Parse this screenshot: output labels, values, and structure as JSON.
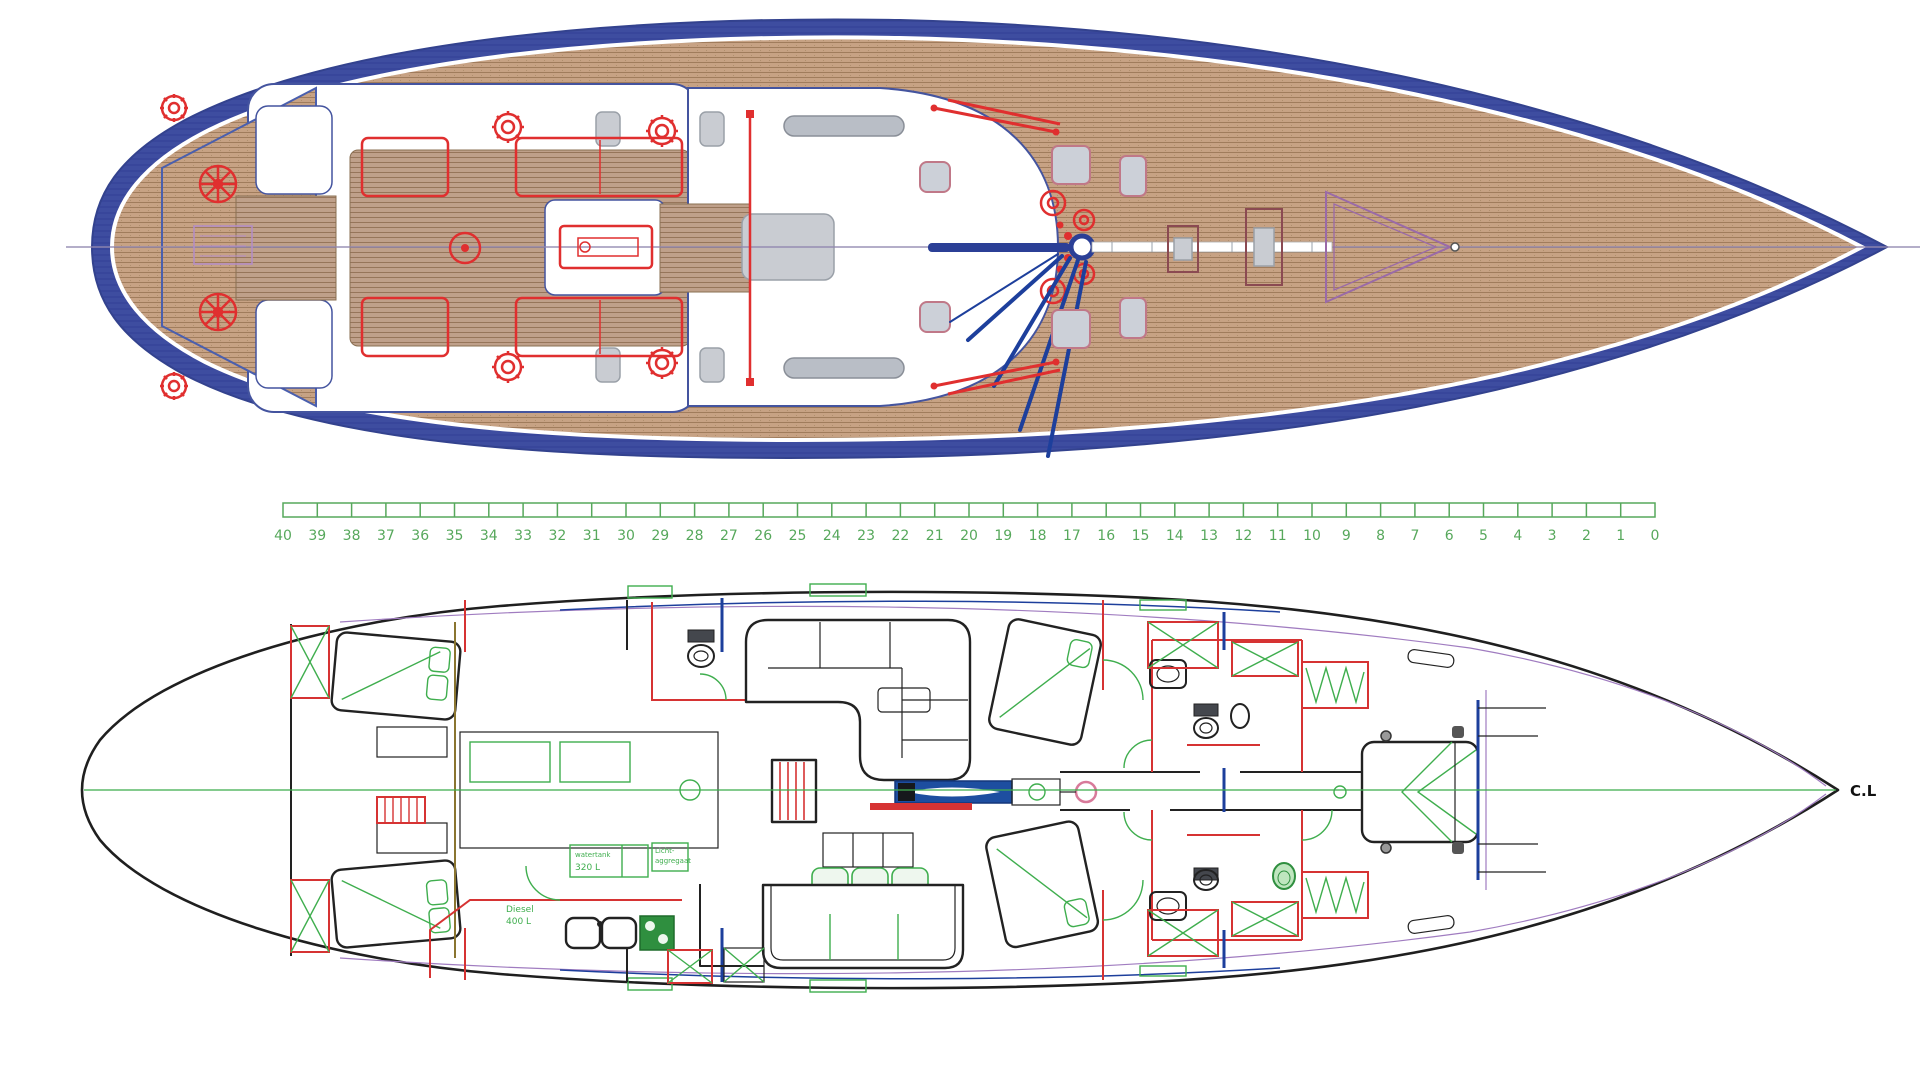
{
  "drawing": {
    "type": "yacht general arrangement drawing",
    "views": [
      "deck-plan",
      "frame-ruler",
      "interior-accommodation-plan"
    ]
  },
  "colors": {
    "deck-blue": "#3e4da0",
    "deck-blue-dark": "#33428e",
    "teak": "#c7a284",
    "teak-line": "#a07c5c",
    "cockpit-floor": "#bfa08a",
    "coach-edge": "#44549f",
    "hw-red": "#e02f2f",
    "gray-hatch": "#c9ccd2",
    "rail-gray": "#b9bec6",
    "pink": "#c07888",
    "maroon": "#8b4a52",
    "purple": "#a07cc0",
    "ruler-green": "#57a85c",
    "plan-black": "#222222",
    "plan-red": "#d63333",
    "plan-green": "#3fae4e",
    "plan-blue": "#1d3f9c",
    "trunk-blue": "#1d4ea0",
    "olive": "#8a7530"
  },
  "ruler": {
    "x_start": 283,
    "x_end": 1655,
    "y": 503,
    "bar_h": 14,
    "label_y": 540,
    "labels": [
      "40",
      "39",
      "38",
      "37",
      "36",
      "35",
      "34",
      "33",
      "32",
      "31",
      "30",
      "29",
      "28",
      "27",
      "26",
      "25",
      "24",
      "23",
      "22",
      "21",
      "20",
      "19",
      "18",
      "17",
      "16",
      "15",
      "14",
      "13",
      "12",
      "11",
      "10",
      "9",
      "8",
      "7",
      "6",
      "5",
      "4",
      "3",
      "2",
      "1",
      "0"
    ]
  },
  "plan_labels": {
    "centerline": "C.L",
    "tank1_line1": "watertank",
    "tank1_line2": "320 L",
    "tank2_line1": "Licht-",
    "tank2_line2": "aggregaat",
    "fuel_line1": "Diesel",
    "fuel_line2": "400 L"
  }
}
